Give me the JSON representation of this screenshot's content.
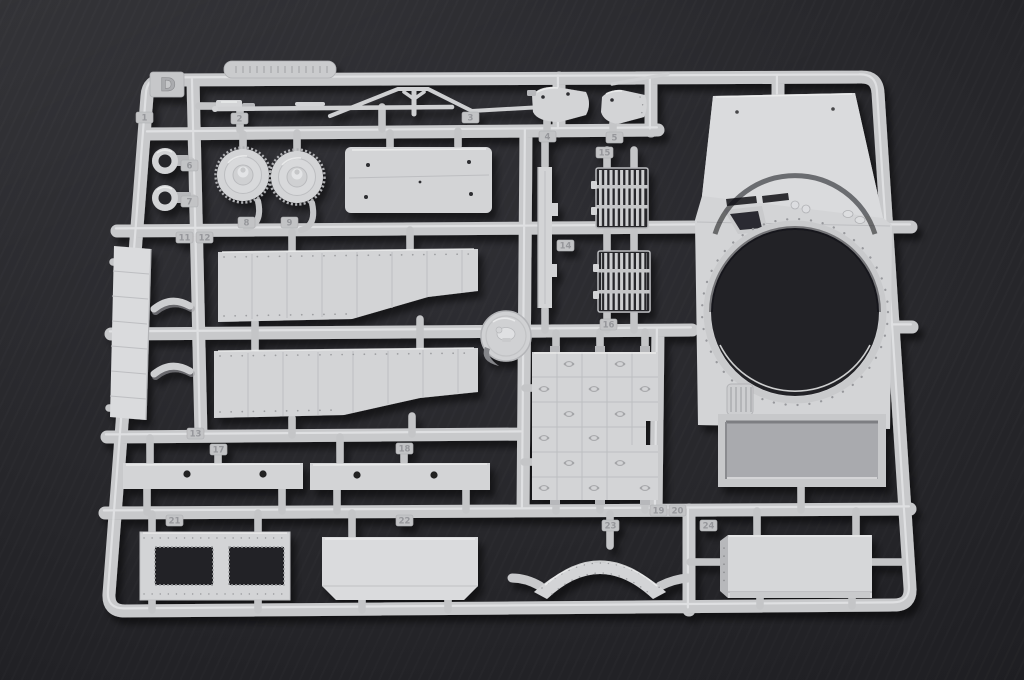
{
  "photo": {
    "subject": "Light grey injection-molded plastic model-kit sprue (parts runner) photographed on a dark grey surface",
    "sprue_letter": "D",
    "embossed_plate_text": "molded part/mould number (illegible)",
    "palette": {
      "plastic": "#d3d4d6",
      "plastic_highlight": "#e8e9eb",
      "plastic_shadow": "#9b9c9f",
      "background": "#27272b"
    },
    "part_number_tabs": [
      {
        "label": "1",
        "x": 136,
        "y": 112
      },
      {
        "label": "2",
        "x": 231,
        "y": 113
      },
      {
        "label": "3",
        "x": 462,
        "y": 112
      },
      {
        "label": "4",
        "x": 539,
        "y": 131
      },
      {
        "label": "5",
        "x": 606,
        "y": 132
      },
      {
        "label": "6",
        "x": 181,
        "y": 160
      },
      {
        "label": "7",
        "x": 181,
        "y": 196
      },
      {
        "label": "8",
        "x": 238,
        "y": 217
      },
      {
        "label": "9",
        "x": 281,
        "y": 217
      },
      {
        "label": "11",
        "x": 176,
        "y": 232
      },
      {
        "label": "12",
        "x": 196,
        "y": 232
      },
      {
        "label": "13",
        "x": 187,
        "y": 428
      },
      {
        "label": "14",
        "x": 557,
        "y": 240
      },
      {
        "label": "15",
        "x": 596,
        "y": 147
      },
      {
        "label": "16",
        "x": 600,
        "y": 319
      },
      {
        "label": "17",
        "x": 210,
        "y": 444
      },
      {
        "label": "18",
        "x": 396,
        "y": 443
      },
      {
        "label": "19",
        "x": 650,
        "y": 505
      },
      {
        "label": "20",
        "x": 669,
        "y": 505
      },
      {
        "label": "21",
        "x": 166,
        "y": 515
      },
      {
        "label": "22",
        "x": 396,
        "y": 515
      },
      {
        "label": "23",
        "x": 602,
        "y": 520
      },
      {
        "label": "24",
        "x": 700,
        "y": 520
      }
    ],
    "notable_parts": [
      "turret roof panel with large circular turret-ring opening and rectangular recess",
      "two slatted engine intake grilles",
      "two riveted side-skirt fender panels",
      "treadplate floor panel with tie-down ovals",
      "two domed ventilator covers",
      "two small ring collars",
      "round access hatch",
      "segmented side sill strip with grab handles",
      "two drilled mounting strips",
      "frame plate with two rectangular openings",
      "panel with clipped corners",
      "curved riveted fender arch",
      "large stowage box panel",
      "thin tow rods and small fittings"
    ]
  }
}
